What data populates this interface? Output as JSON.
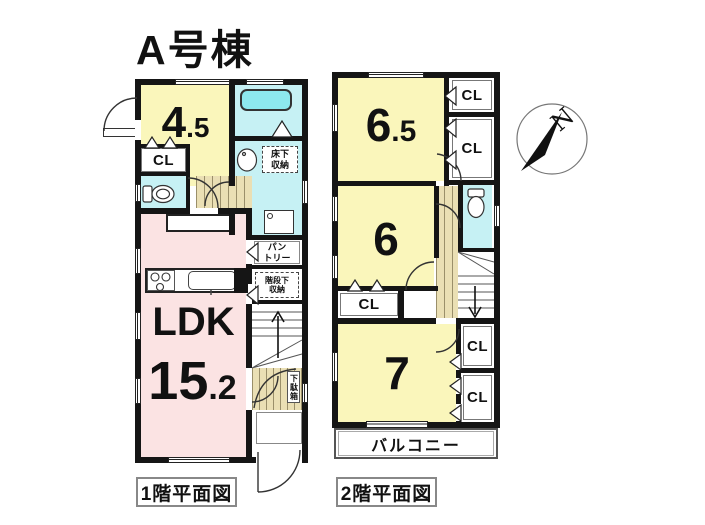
{
  "title": "A号棟",
  "compass": {
    "north": "N"
  },
  "floor1": {
    "caption": "1階平面図",
    "tatami_room": {
      "main": "4",
      "frac": ".5"
    },
    "closet": "CL",
    "ldk": {
      "name": "LDK",
      "main": "15",
      "frac": ".2"
    },
    "underfloor_storage": {
      "line1": "床下",
      "line2": "収納"
    },
    "pantry": {
      "line1": "パン",
      "line2": "トリー"
    },
    "understairs_storage": {
      "line1": "階段下",
      "line2": "収納"
    },
    "shoe_cabinet": "下駄箱"
  },
  "floor2": {
    "caption": "2階平面図",
    "room_65": {
      "main": "6",
      "frac": ".5"
    },
    "room_6": "6",
    "room_7": "7",
    "closet_labels": [
      "CL",
      "CL",
      "CL",
      "CL",
      "CL"
    ],
    "balcony": "バルコニー"
  },
  "colors": {
    "wall": "#151515",
    "room_yellow": "#faf6bb",
    "ldk_pink": "#fbe3e3",
    "water_cyan": "#c6f1f4",
    "bathtub_cyan": "#8de8ee",
    "floor_beige": "#eadfb4"
  }
}
